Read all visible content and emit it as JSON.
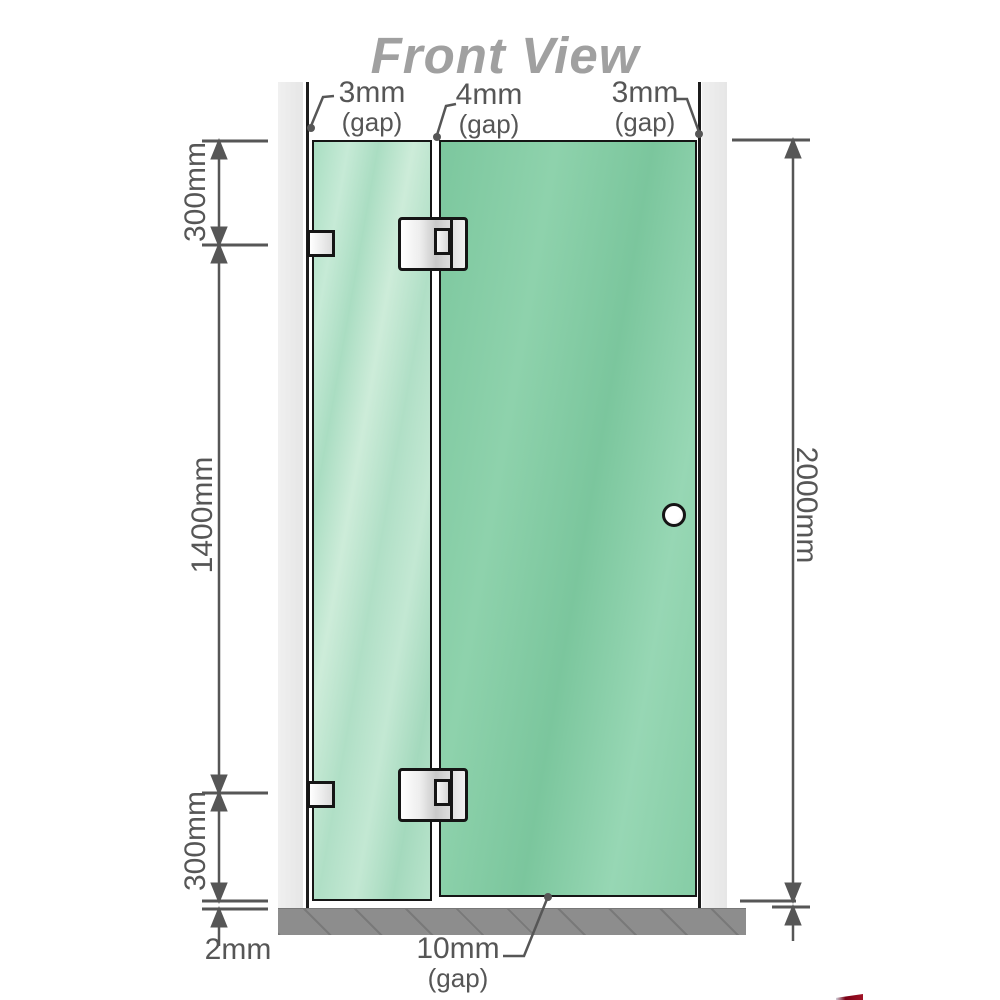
{
  "title": "Front View",
  "diagram": {
    "top_gaps": {
      "left": {
        "value": "3mm",
        "label": "(gap)"
      },
      "middle": {
        "value": "4mm",
        "label": "(gap)"
      },
      "right": {
        "value": "3mm",
        "label": "(gap)"
      }
    },
    "left_dimensions": {
      "top": "300mm",
      "middle": "1400mm",
      "bottom": "300mm",
      "floor_gap": "2mm"
    },
    "right_dimension": {
      "total_height": "2000mm"
    },
    "bottom_gap": {
      "value": "10mm",
      "label": "(gap)"
    }
  },
  "colors": {
    "glass_green_door": "#84cca4",
    "glass_green_fixed": "#b4e1c8",
    "wall_gray": "#eaeaea",
    "floor_gray": "#8d8d8d",
    "dimension_gray": "#565656",
    "title_gray": "#a0a0a0",
    "hardware_white": "#f0f0f0",
    "accent_red": "#8b0016"
  }
}
